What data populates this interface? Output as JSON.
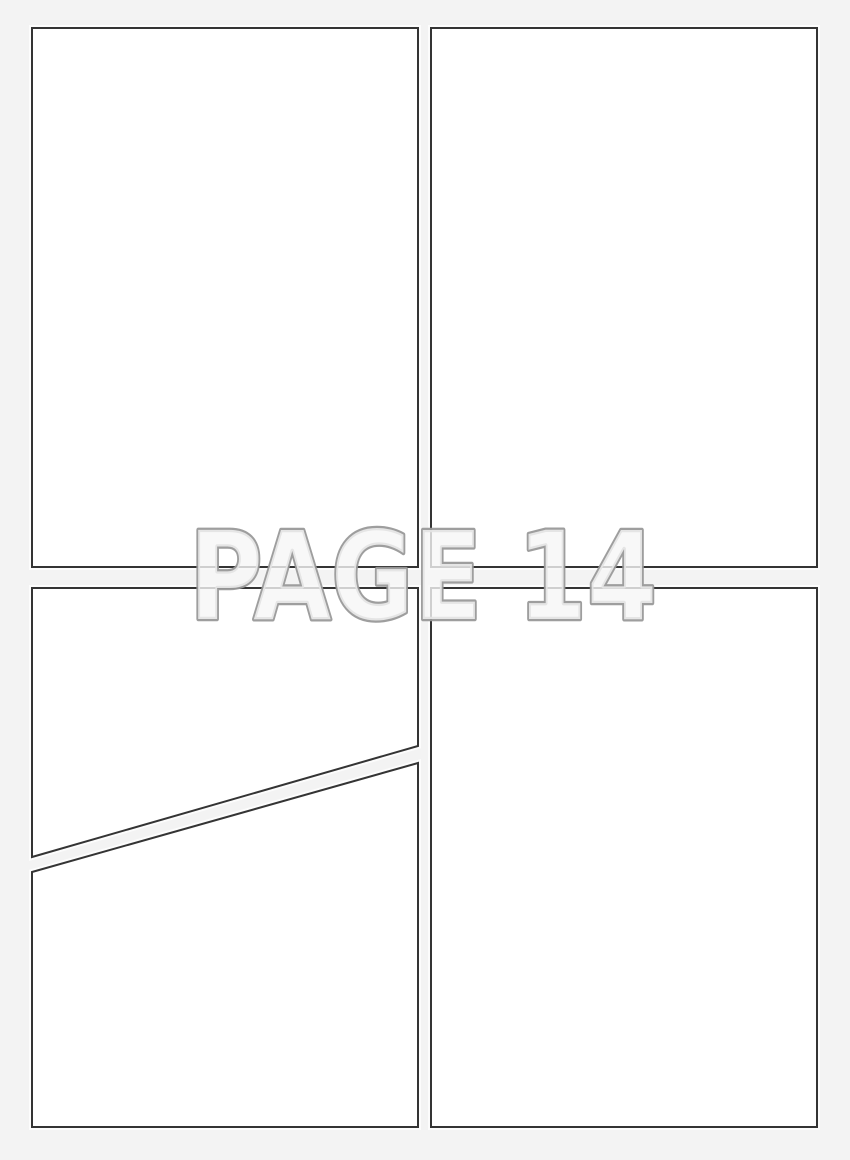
{
  "document": {
    "kind": "blank comic page template",
    "watermark": {
      "text": "PAGE 14",
      "label": "PAGE",
      "page_number": "14",
      "fill_color": "#f6f6f6",
      "outline_color": "#999999"
    },
    "colors": {
      "background": "#f3f3f3",
      "panel_fill": "#ffffff",
      "panel_border": "#343434",
      "panel_halo": "#ffffff"
    },
    "panels": [
      {
        "id": "top-left",
        "shape": "rectangle"
      },
      {
        "id": "top-right",
        "shape": "rectangle"
      },
      {
        "id": "bottom-left-upper",
        "shape": "polygon-diagonal-bottom"
      },
      {
        "id": "bottom-left-lower",
        "shape": "polygon-diagonal-top"
      },
      {
        "id": "bottom-right",
        "shape": "rectangle"
      }
    ]
  }
}
